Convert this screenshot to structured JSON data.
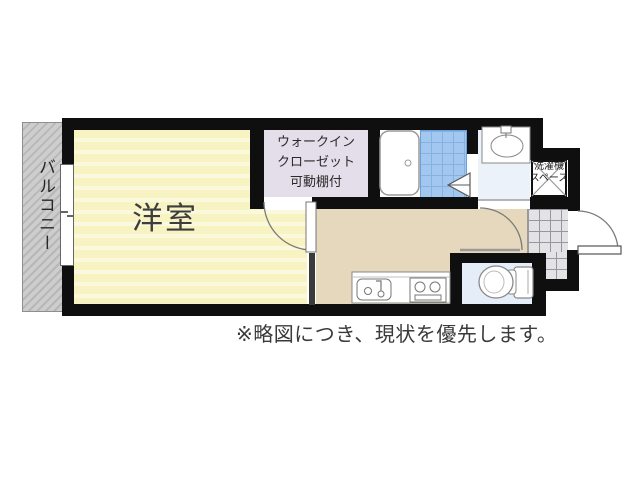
{
  "floorplan": {
    "note": "※略図につき、現状を優先します。",
    "rooms": {
      "balcony": {
        "label": "バルコニー"
      },
      "western_room": {
        "label": "洋室"
      },
      "walk_in_closet": {
        "label_lines": [
          "ウォークイン",
          "クローゼット",
          "可動棚付"
        ]
      },
      "washer_space": {
        "label_lines": [
          "洗濯機",
          "スペース"
        ]
      }
    },
    "colors": {
      "wall": "#0f0f0f",
      "western_room_fill": "#f8f3c2",
      "closet_fill": "#e3dee9",
      "kitchen_hall_fill": "#e5d8bd",
      "bath_tile_fill": "#a3c8ef",
      "washroom_fill": "#ebf2fa",
      "toilet_room_fill": "#e4edf8",
      "balcony_fill": "#c9c9c9",
      "entrance_tile_fill": "#e3e3e5"
    }
  }
}
